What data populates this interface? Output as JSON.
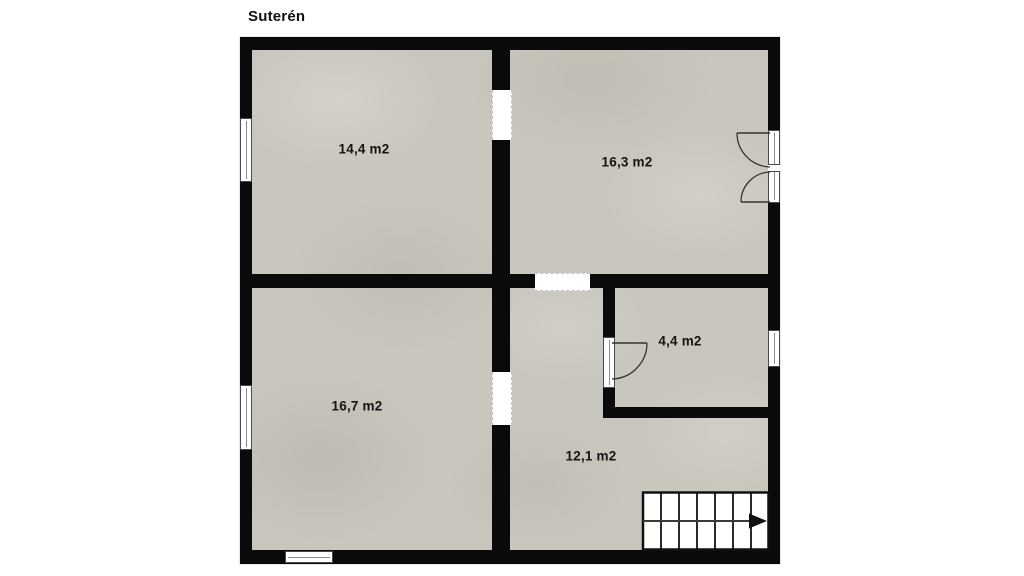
{
  "title": "Suterén",
  "rooms": [
    {
      "id": "top-left",
      "area_label": "14,4 m2"
    },
    {
      "id": "top-right",
      "area_label": "16,3 m2"
    },
    {
      "id": "bottom-left",
      "area_label": "16,7 m2"
    },
    {
      "id": "bottom-right",
      "area_label": "12,1 m2"
    },
    {
      "id": "small-room",
      "area_label": "4,4 m2"
    }
  ],
  "features": {
    "stairs": {
      "treads": 7,
      "direction_arrow": "right"
    },
    "windows_count": 4,
    "doors": {
      "double_door_right_wall": 1,
      "single_door_small_room": 1,
      "wall_openings": 3
    }
  },
  "colors": {
    "wall": "#0a0a0a",
    "floor": "#c9c6bd",
    "background": "#ffffff",
    "label_text": "#141414"
  }
}
